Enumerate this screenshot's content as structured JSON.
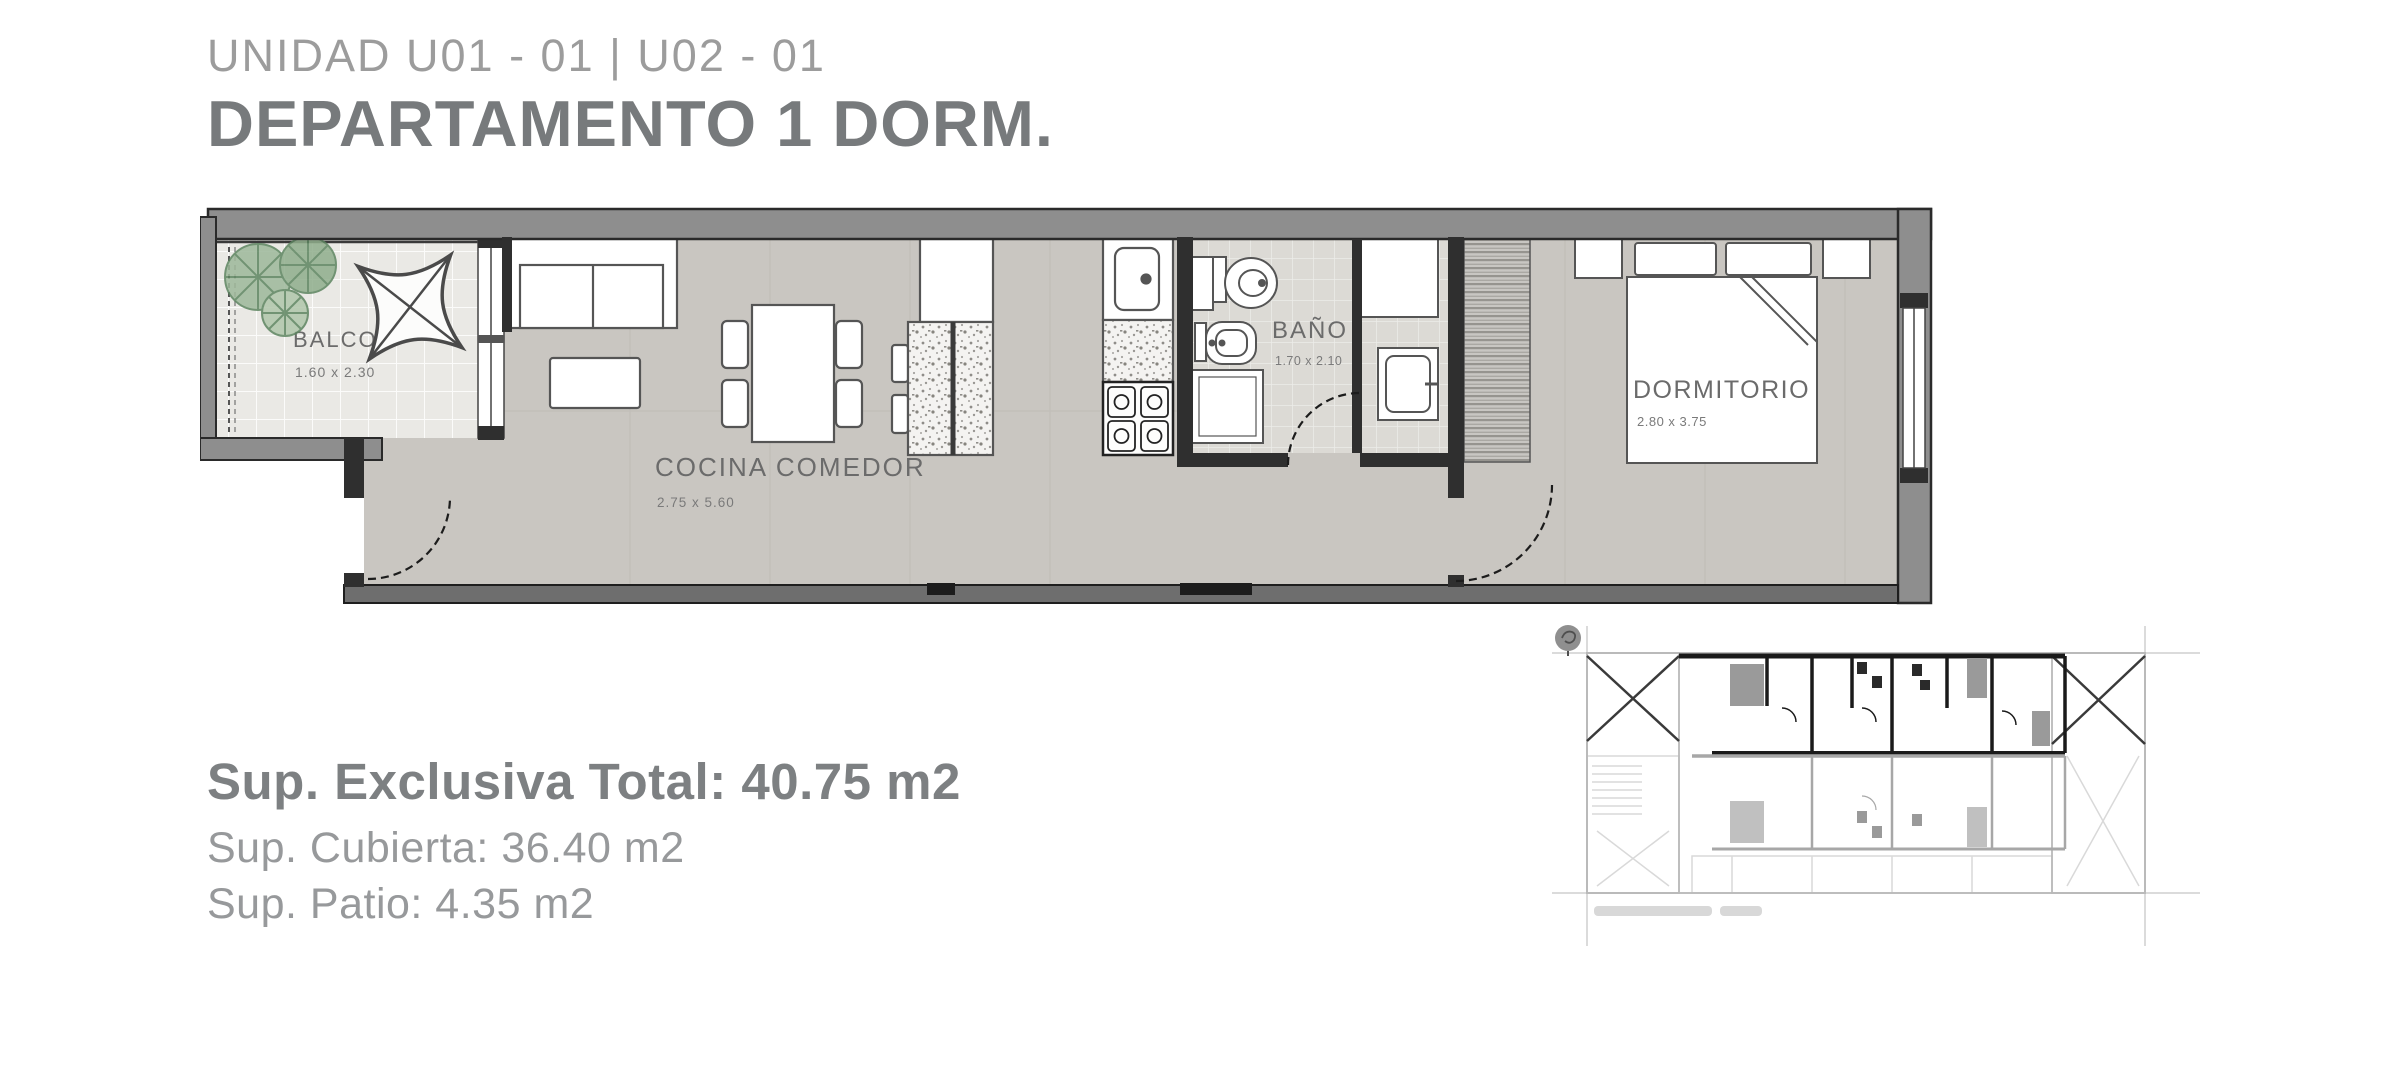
{
  "header": {
    "unit_line": "UNIDAD U01 - 01 | U02 - 01",
    "type_line": "DEPARTAMENTO 1 DORM."
  },
  "rooms": {
    "balcon": {
      "name": "BALCON",
      "dims": "1.60 x 2.30"
    },
    "cocina": {
      "name": "COCINA COMEDOR",
      "dims": "2.75 x 5.60"
    },
    "bano": {
      "name": "BAÑO",
      "dims": "1.70 x 2.10"
    },
    "dormitorio": {
      "name": "DORMITORIO",
      "dims": "2.80 x 3.75"
    }
  },
  "areas": {
    "total": "Sup. Exclusiva Total: 40.75 m2",
    "cubierta": "Sup. Cubierta: 36.40 m2",
    "patio": "Sup. Patio: 4.35 m2"
  },
  "colors": {
    "title_light": "#9c9c9c",
    "title_dark": "#777a7c",
    "wall_gray": "#8e8e8e",
    "wall_dark": "#2f2f2f",
    "floor": "#c9c6c1",
    "balcony_tile": "#eae9e5",
    "bath_floor": "#dcdad5",
    "plant_green": "#7fa07c",
    "label_gray": "#6b6b6b"
  }
}
